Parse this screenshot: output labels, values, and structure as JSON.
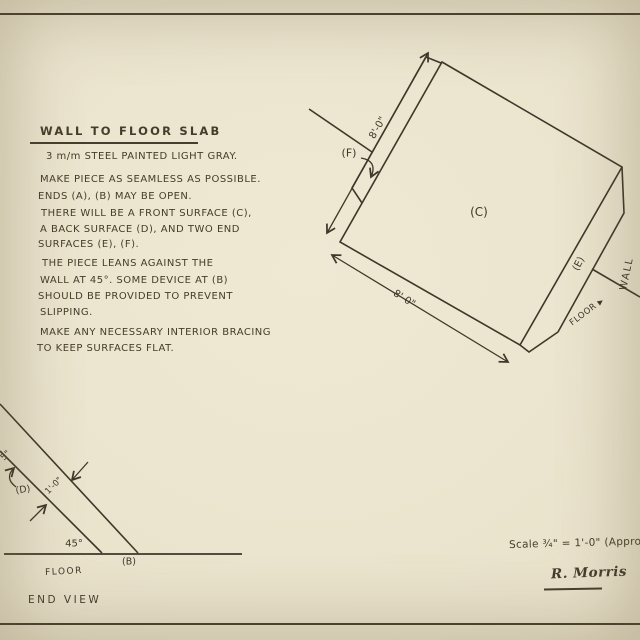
{
  "palette": {
    "paper": "#e9e2cb",
    "ink": "#3f372a"
  },
  "icons": {
    "solid_arrow": "▶"
  },
  "notes": {
    "title": "WALL TO FLOOR SLAB",
    "lines": [
      "3 m/m STEEL PAINTED LIGHT GRAY.",
      "MAKE PIECE AS SEAMLESS AS POSSIBLE.",
      "ENDS (A), (B) MAY BE OPEN.",
      "THERE WILL BE A FRONT SURFACE (C),",
      "A BACK SURFACE (D), AND TWO END",
      "SURFACES (E), (F).",
      "THE PIECE LEANS AGAINST THE",
      "WALL AT 45°. SOME DEVICE AT (B)",
      "SHOULD BE PROVIDED TO PREVENT",
      "SLIPPING.",
      "MAKE ANY NECESSARY INTERIOR BRACING",
      "TO KEEP SURFACES FLAT."
    ]
  },
  "iso_view": {
    "front_label": "(C)",
    "end_top_label": "(F)",
    "end_right_label": "(E)",
    "wall_label": "WALL",
    "floor_label": "FLOOR",
    "dim_top": "8'-0\"",
    "dim_bottom": "8'-0\""
  },
  "end_view": {
    "caption": "END VIEW",
    "floor_label": "FLOOR",
    "angle_label": "45°",
    "bottom_edge_label": "(B)",
    "back_surface_label": "(D)",
    "thickness_dim": "1'-0\"",
    "edge_dim_fragment": "5\""
  },
  "footer": {
    "scale_note": "Scale ¾\" = 1'-0\" (Approxim",
    "signature": "R. Morris"
  }
}
